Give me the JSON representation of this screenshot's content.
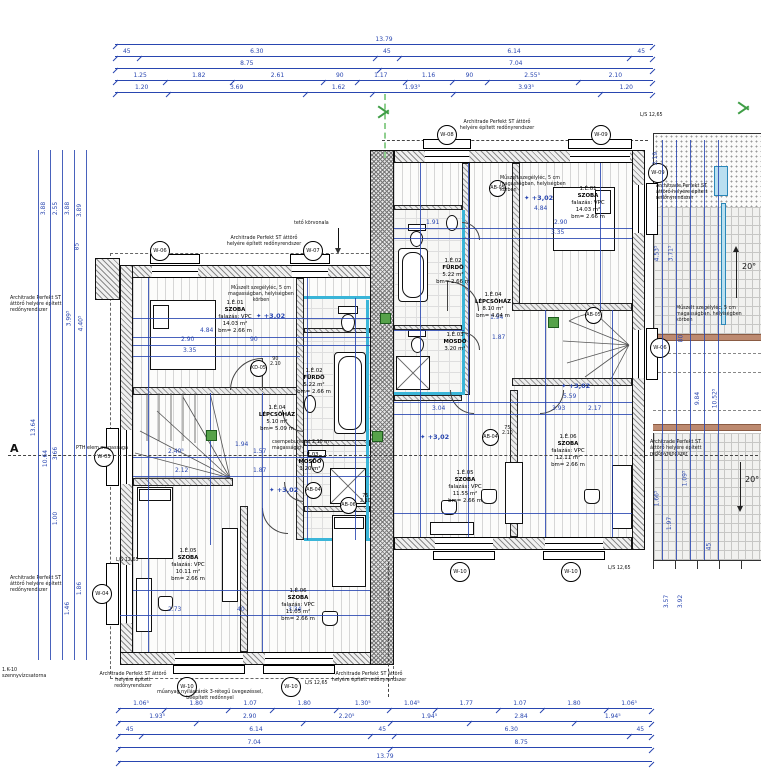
{
  "watermark": {
    "line1": "OTTHON",
    "line2": "CENTRUM"
  },
  "section": {
    "label": "A"
  },
  "level_marker": "+3,02",
  "roof": {
    "slope": "20°",
    "outline_note": "tető körvonala"
  },
  "notes": {
    "shutter": "Architrade Perfekt ST áttörő helyére épített redőnyrendszer",
    "skirting": "Műszelt szegélyléc, 5 cm magasságban, helyiségben körben",
    "tiling": "csempeburkolat 2,10 m magasságig",
    "glazing": "műanyag nyílászárók 3-rétegű üvegezéssel, beépített redőnnyel",
    "pth": "PTH elem magassága",
    "sewer": "1.K-10 szennyvízcsatorna",
    "ls": "L/S 12,65"
  },
  "rooms": {
    "left": [
      {
        "id": "1.É.01",
        "name": "SZOBA",
        "wall": "falazás: VPC",
        "area": "14.03 m²",
        "height": "bm= 2.66 m"
      },
      {
        "id": "1.É.02",
        "name": "FÜRDŐ",
        "wall": "",
        "area": "5.22 m²",
        "height": "bm= 2.66 m"
      },
      {
        "id": "1.É.03",
        "name": "MOSDÓ",
        "wall": "",
        "area": "3.20 m²",
        "height": "bm= 2.66 m"
      },
      {
        "id": "1.É.04",
        "name": "LÉPCSŐHÁZ",
        "wall": "",
        "area": "5.10 m²",
        "height": "bm= 5.09 m"
      },
      {
        "id": "1.É.05",
        "name": "SZOBA",
        "wall": "falazás: VPC",
        "area": "10.11 m²",
        "height": "bm= 2.66 m"
      },
      {
        "id": "1.É.06",
        "name": "SZOBA",
        "wall": "falazás: VPC",
        "area": "11.05 m²",
        "height": "bm= 2.66 m"
      }
    ],
    "right": [
      {
        "id": "1.É.01",
        "name": "SZOBA",
        "wall": "falazás: VPC",
        "area": "14.03 m²",
        "height": "bm= 2.66 m"
      },
      {
        "id": "1.É.02",
        "name": "FÜRDŐ",
        "wall": "",
        "area": "5.22 m²",
        "height": "bm= 2.66 m"
      },
      {
        "id": "1.É.03",
        "name": "MOSDÓ",
        "wall": "",
        "area": "3.20 m²",
        "height": "bm= 2.66 m"
      },
      {
        "id": "1.É.04",
        "name": "LÉPCSŐHÁZ",
        "wall": "",
        "area": "8.10 m²",
        "height": "bm= 4.04 m"
      },
      {
        "id": "1.É.05",
        "name": "SZOBA",
        "wall": "falazás: VPC",
        "area": "11.55 m²",
        "height": "bm= 2.66 m"
      },
      {
        "id": "1.É.06",
        "name": "SZOBA",
        "wall": "falazás: VPC",
        "area": "12.11 m²",
        "height": "bm= 2.66 m"
      }
    ]
  },
  "bubbles": [
    "W-06",
    "W-07",
    "W-08",
    "W-09",
    "W-10",
    "W-10",
    "W-10",
    "W-10",
    "W-05",
    "W-04",
    "W-09",
    "W-06"
  ],
  "door_bubbles": [
    "KD-05",
    "AB-06",
    "AB-04",
    "AB-05",
    "AB-04",
    "AB-05"
  ],
  "door_sizes": {
    "a": {
      "w": "90",
      "h": "2.10"
    },
    "b": {
      "w": "75",
      "h": "2.10"
    }
  },
  "dims": {
    "top": [
      [
        "13.79"
      ],
      [
        "45",
        "6.30",
        "45",
        "6.14",
        "45"
      ],
      [
        "8.75",
        "7.04"
      ],
      [
        "1.25",
        "1.82",
        "2.61",
        "90",
        "1.17",
        "1.16",
        "90",
        "2.55⁵",
        "2.10"
      ],
      [
        "1.20",
        "3.69",
        "1.62",
        "1.93⁵",
        "3.93⁵",
        "1.20"
      ]
    ],
    "bottom": [
      [
        "1.06⁵",
        "1.80",
        "1.07",
        "1.80",
        "1.30⁵",
        "1.04⁵",
        "1.77",
        "1.07",
        "1.80",
        "1.06⁵"
      ],
      [
        "1.93⁵",
        "2.90",
        "2.20⁵",
        "1.94⁵",
        "2.84",
        "1.94⁵"
      ],
      [
        "45",
        "6.14",
        "45",
        "6.30",
        "45"
      ],
      [
        "7.04",
        "8.75"
      ],
      [
        "13.79"
      ]
    ],
    "left": [
      "13.64",
      "3.88",
      "10.64",
      "2.55",
      "3.66",
      "1.00",
      "3.88",
      "3.99⁵",
      "1.46",
      "3.89",
      "4.40⁵",
      "85",
      "1.86"
    ],
    "right": [
      "2.19",
      "4.53⁵",
      "1.66⁵",
      "3.71⁵",
      "1.97",
      "80",
      "1.09⁵",
      "9.84",
      "10.52⁵",
      "45",
      "3.57",
      "3.92"
    ],
    "inner": [
      "4.84",
      "2.90",
      "3.35",
      "90",
      "2.40⁵",
      "1.57",
      "2.12",
      "1.87",
      "1.94",
      "2.73",
      "40",
      "3.34",
      "1.91",
      "4.84",
      "2.90",
      "3.35",
      "5.59",
      "2.17",
      "3.04",
      "3.93",
      "1.94",
      "1.87"
    ]
  }
}
